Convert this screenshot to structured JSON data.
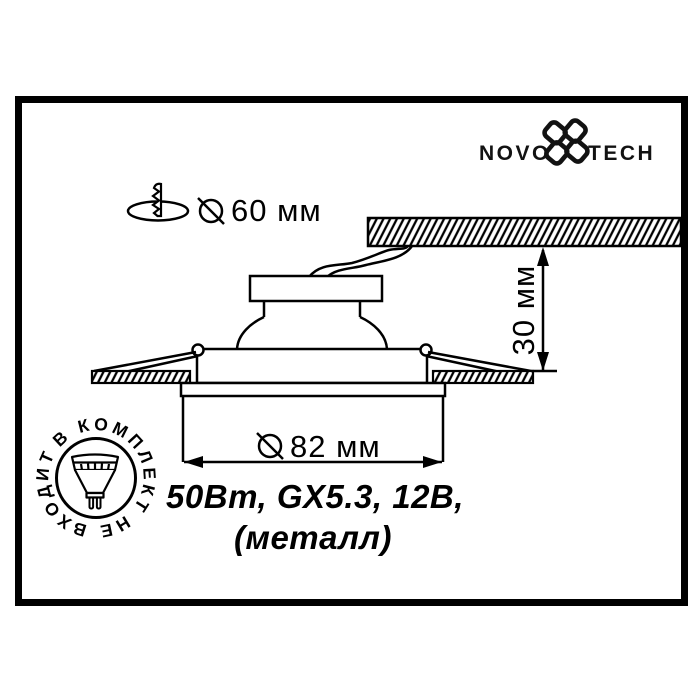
{
  "colors": {
    "ink": "#000000",
    "paper": "#ffffff"
  },
  "logo": {
    "name_left": "NOVO",
    "name_right": "TECH",
    "flower_icon": "novotech-flower-icon"
  },
  "annotations": {
    "cutout_diameter": "60 мм",
    "recess_depth": "30 мм",
    "face_diameter": "82 мм",
    "diameter_symbol_icon": "diameter-symbol-icon",
    "cutout_icon": "ceiling-cutout-screw-icon"
  },
  "specs": {
    "line1": "50Вт, GX5.3, 12В,",
    "line2": "(металл)"
  },
  "badge": {
    "label": "В КОМПЛЕКТ НЕ ВХОДИТ",
    "lamp_icon": "mr16-lamp-icon"
  }
}
